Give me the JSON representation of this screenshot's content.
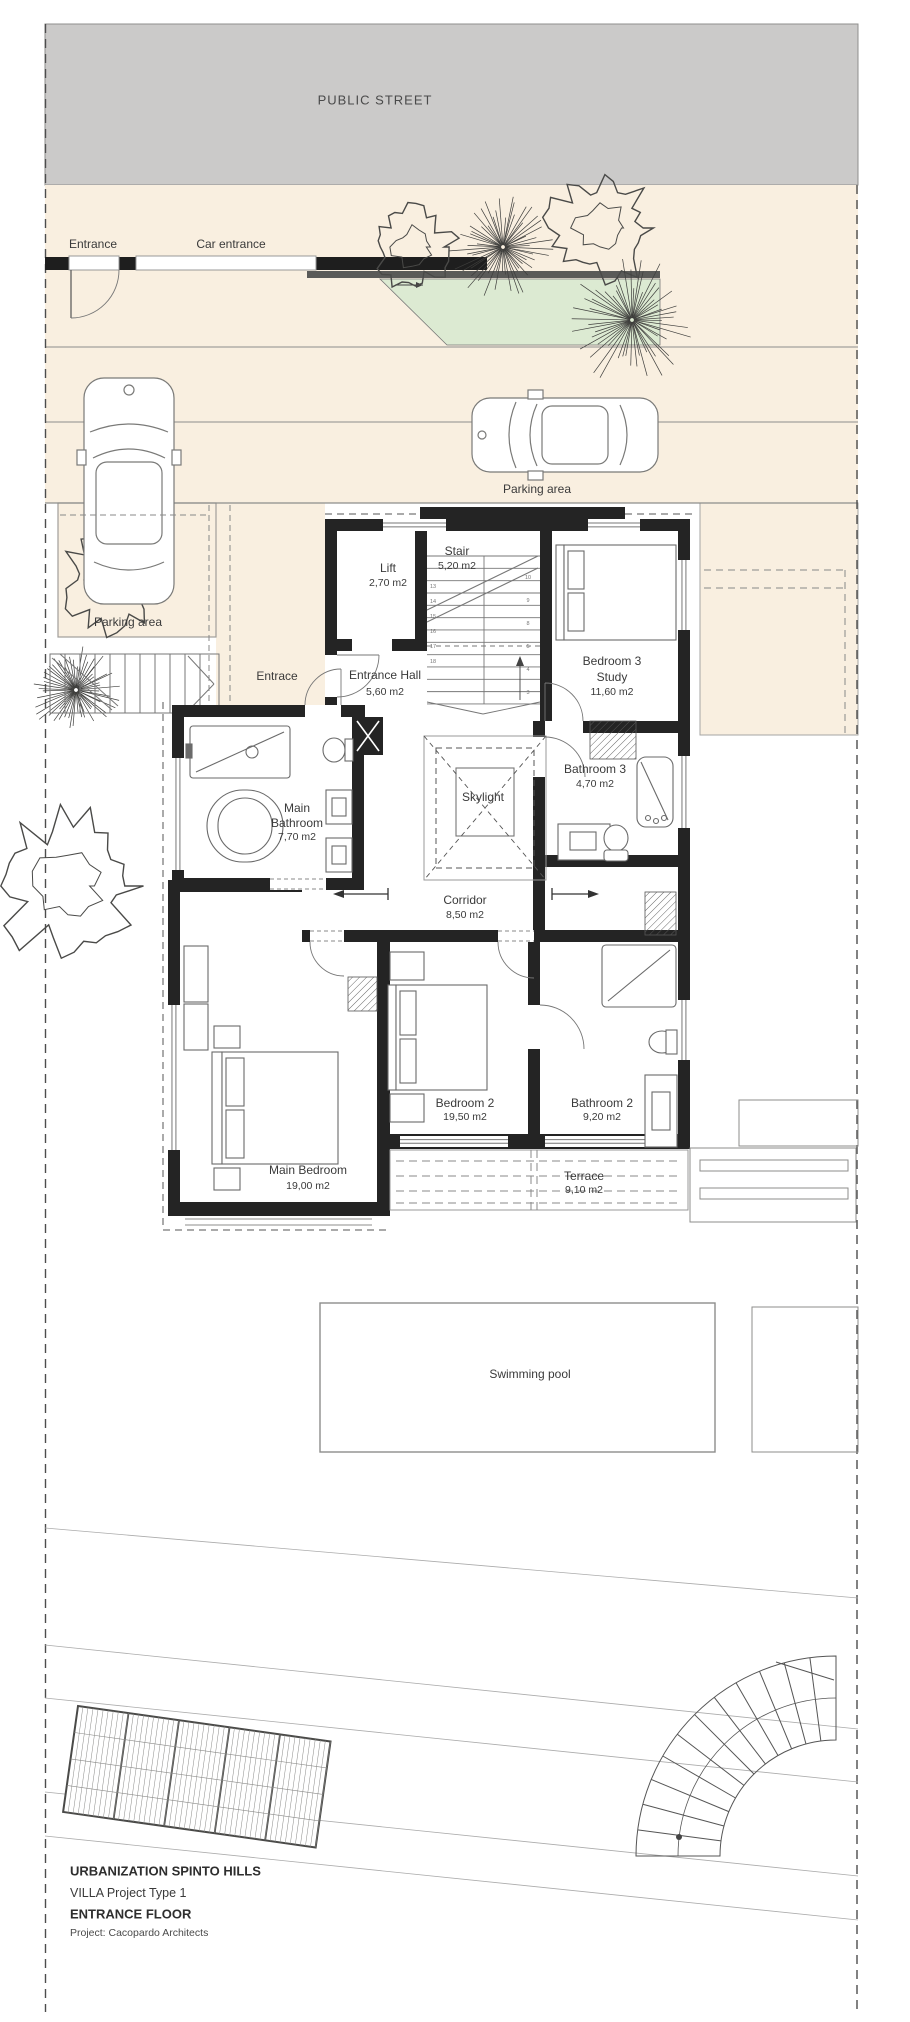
{
  "drawing": {
    "street_label": "PUBLIC STREET",
    "entrance_gate_label": "Entrance",
    "car_entrance_label": "Car entrance",
    "parking_area_top_label": "Parking area",
    "parking_area_left_label": "Parking area",
    "walkway_entrance_label": "Entrace",
    "swimming_pool_label": "Swimming pool"
  },
  "rooms": {
    "lift": {
      "name": "Lift",
      "area": "2,70 m2"
    },
    "stair": {
      "name": "Stair",
      "area": "5,20 m2"
    },
    "bedroom3": {
      "name": "Bedroom 3",
      "name2": "Study",
      "area": "11,60 m2"
    },
    "entrance_hall": {
      "name": "Entrance Hall",
      "area": "5,60 m2"
    },
    "main_bathroom": {
      "name1": "Main",
      "name2": "Bathroom",
      "area": "7,70 m2"
    },
    "skylight": {
      "name": "Skylight"
    },
    "bathroom3": {
      "name": "Bathroom 3",
      "area": "4,70 m2"
    },
    "corridor": {
      "name": "Corridor",
      "area": "8,50 m2"
    },
    "bedroom2": {
      "name": "Bedroom 2",
      "area": "19,50 m2"
    },
    "bathroom2": {
      "name": "Bathroom 2",
      "area": "9,20 m2"
    },
    "main_bedroom": {
      "name": "Main Bedroom",
      "area": "19,00 m2"
    },
    "terrace": {
      "name": "Terrace",
      "area": "9,10 m2"
    }
  },
  "stair_numbers": {
    "left": [
      "13",
      "14",
      "15",
      "16",
      "17",
      "18"
    ],
    "right": [
      "10",
      "9",
      "8",
      "5",
      "4",
      "3"
    ]
  },
  "title_block": {
    "project_name": "URBANIZATION SPINTO HILLS",
    "villa_type": "VILLA Project Type 1",
    "floor_name": "ENTRANCE FLOOR",
    "architect": "Project: Cacopardo Architects"
  },
  "colors": {
    "site_beige": "#f9efe0",
    "street_gray": "#cbcac9",
    "planting_green": "#dcead2",
    "wall_black": "#242424",
    "line_gray": "#8d8d8b"
  }
}
